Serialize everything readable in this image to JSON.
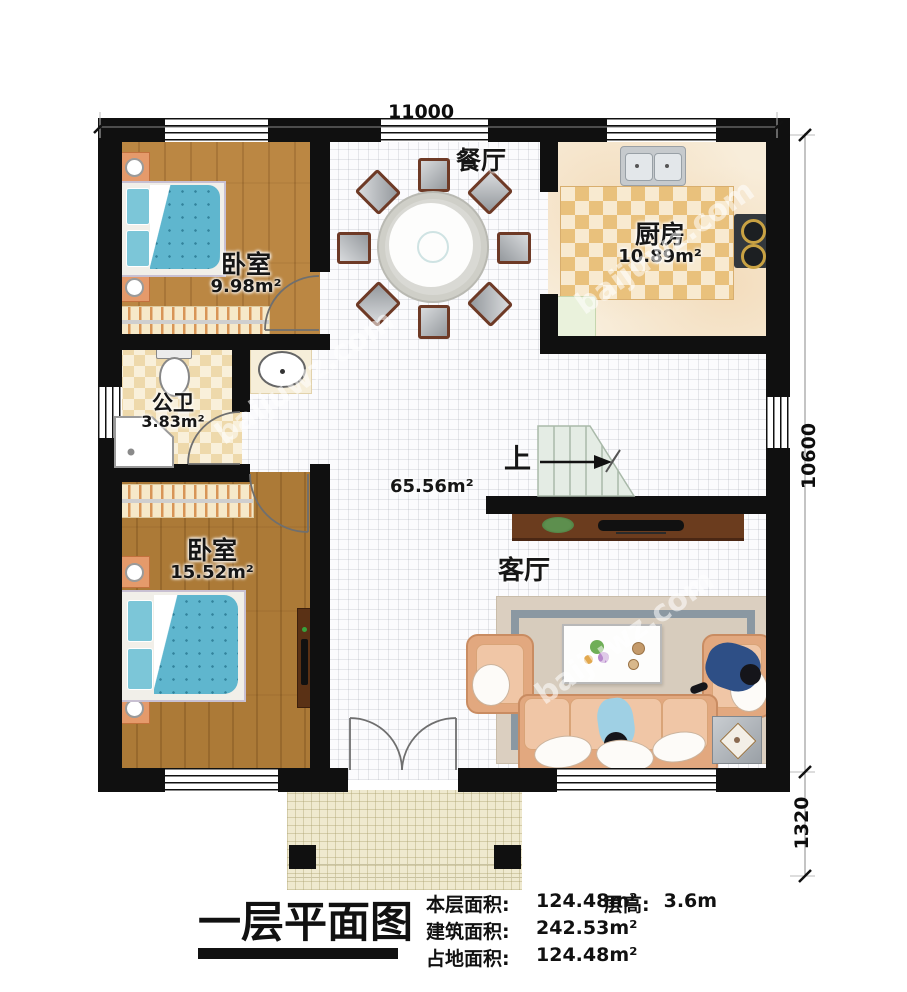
{
  "dimensions": {
    "top_width": "11000",
    "right_main_height": "10600",
    "right_porch_height": "1320"
  },
  "rooms": {
    "bedroom_top": {
      "name": "卧室",
      "area": "9.98m²"
    },
    "kitchen": {
      "name": "厨房",
      "area": "10.89m²"
    },
    "bathroom": {
      "name": "公卫",
      "area": "3.83m²"
    },
    "bedroom_bottom": {
      "name": "卧室",
      "area": "15.52m²"
    },
    "dining": {
      "name": "餐厅"
    },
    "living": {
      "name": "客厅"
    },
    "hall": {
      "area": "65.56m²"
    },
    "stairs": {
      "direction_label": "上"
    }
  },
  "furniture_icons": [
    "double-bed",
    "nightstand",
    "wardrobe-hangers",
    "round-dining-table",
    "dining-chair",
    "kitchen-sink",
    "gas-stove",
    "cutting-board",
    "toilet",
    "corner-shower",
    "wash-basin",
    "stairs-up",
    "tv-console",
    "potted-plant",
    "television",
    "rug",
    "coffee-table",
    "three-seat-sofa",
    "armchair",
    "side-table",
    "person",
    "entry-double-door",
    "porch-column"
  ],
  "footer": {
    "plan_title": "一层平面图",
    "stats": [
      {
        "label": "本层面积:",
        "value": "124.48m²"
      },
      {
        "label": "建筑面积:",
        "value": "242.53m²"
      },
      {
        "label": "占地面积:",
        "value": "124.48m²"
      }
    ],
    "floor_height": {
      "label": "层高:",
      "value": "3.6m"
    }
  },
  "watermark": {
    "text": "baijuwz.com"
  },
  "colors": {
    "wall": "#101010",
    "wood_floor": "#b5823f",
    "kitchen_checker": "#e9c17c",
    "mattress_blue": "#5fb6ce",
    "sofa_peach": "#e2a87f",
    "stair_green": "#e4ece4"
  }
}
